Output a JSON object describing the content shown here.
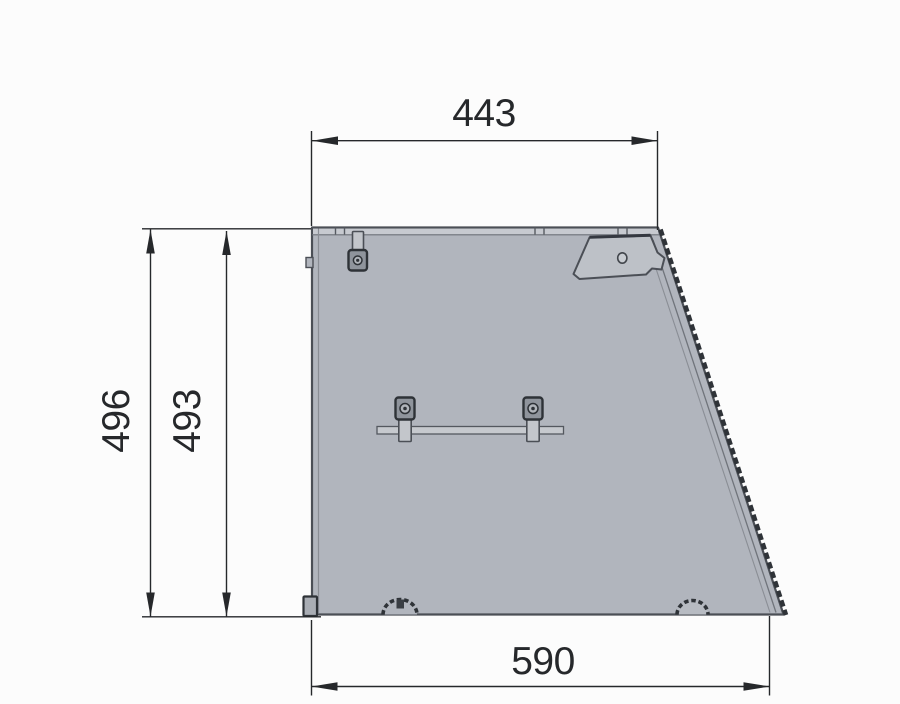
{
  "drawing": {
    "dimensions": {
      "top_width": "443",
      "overall_height": "496",
      "inner_height": "493",
      "bottom_width": "590"
    },
    "colors": {
      "background": "#fcfcfc",
      "panel_fill": "#b1b5bd",
      "panel_band_fill": "#c7cad0",
      "flap_fill": "#bdc1c7",
      "outline": "#4b4f56",
      "hardware_dark": "#2e3237",
      "edge_trim": "#2f3338",
      "dimension_line": "#26282b"
    }
  }
}
